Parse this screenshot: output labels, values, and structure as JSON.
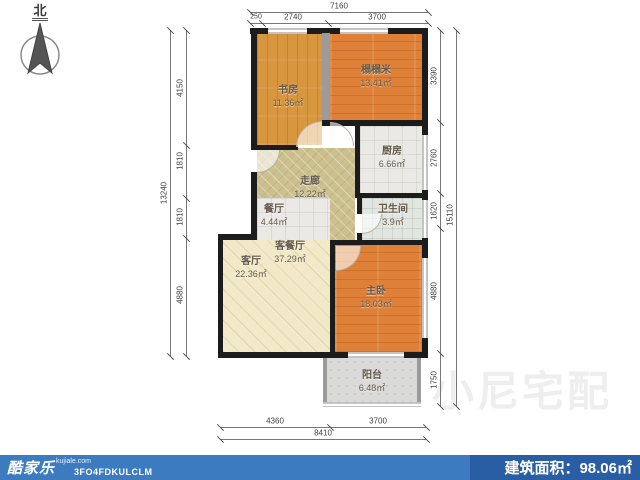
{
  "compass": {
    "north": "北"
  },
  "rooms": [
    {
      "name": "书房",
      "area": "11.36㎡"
    },
    {
      "name": "榻榻米",
      "area": "13.41㎡"
    },
    {
      "name": "厨房",
      "area": "6.66㎡"
    },
    {
      "name": "走廊",
      "area": "12.22㎡"
    },
    {
      "name": "餐厅",
      "area": "4.44㎡"
    },
    {
      "name": "卫生间",
      "area": "3.9㎡"
    },
    {
      "name": "客餐厅",
      "area": "37.29㎡"
    },
    {
      "name": "客厅",
      "area": "22.36㎡"
    },
    {
      "name": "主卧",
      "area": "18.03㎡"
    },
    {
      "name": "阳台",
      "area": "6.48㎡"
    }
  ],
  "dimensions": {
    "top": {
      "overall": "7160",
      "segments": [
        "250",
        "2740",
        "3700"
      ]
    },
    "bottom": {
      "overall": "8410",
      "segments": [
        "4360",
        "3700"
      ]
    },
    "left": {
      "overall": "13240",
      "segments": [
        "4150",
        "1810",
        "1810",
        "4880"
      ]
    },
    "right": {
      "overall": "15110",
      "segments": [
        "3390",
        "2760",
        "1620",
        "4880",
        "1750"
      ]
    }
  },
  "watermark": {
    "text": "小尼宅配"
  },
  "footer": {
    "brand": "酷家乐",
    "domain": "kujiale.com",
    "code": "3FO4FDKULCLM",
    "area_label": "建筑面积：",
    "area_value": "98.06㎡",
    "left_bg": "#3c7bc0",
    "right_bg": "#2a5ea4"
  }
}
